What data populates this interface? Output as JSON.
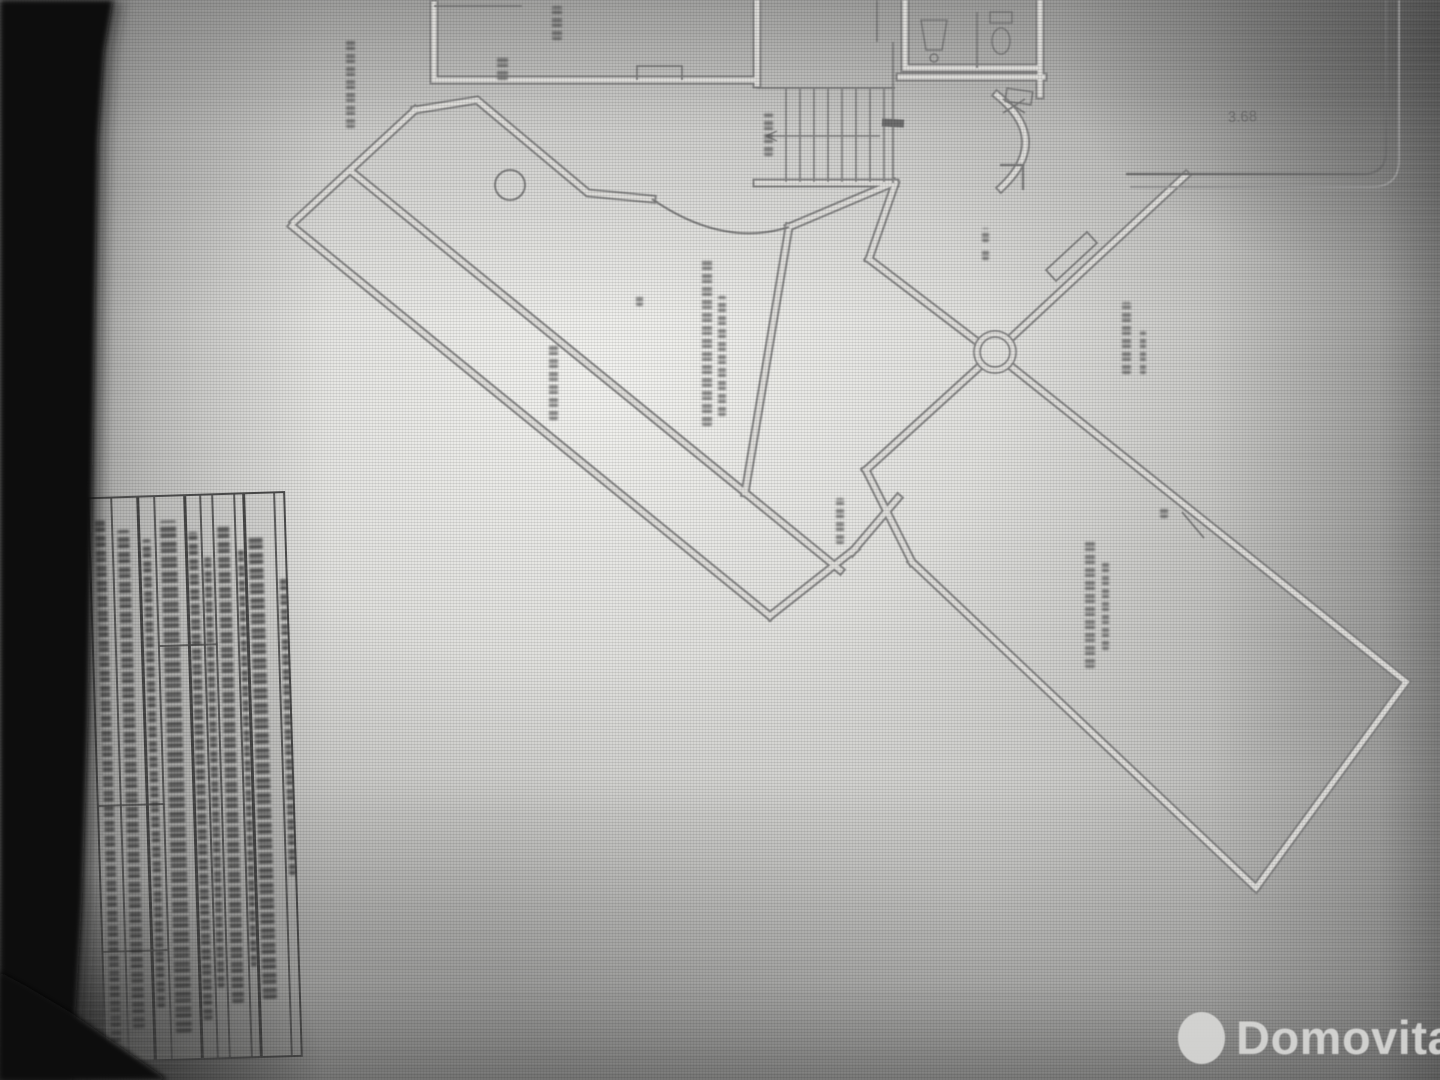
{
  "watermark": {
    "brand": "Domovita"
  },
  "plan": {
    "dimension_label": "3.68",
    "drawing_type": "floor-plan"
  },
  "colors": {
    "paper_highlight": "#f0f0ed",
    "paper_shadow": "#8c8c8a",
    "ink_line": "#7d7d7d",
    "photo_black": "#0e0e0e",
    "watermark_gray": "#d8d8d6"
  }
}
